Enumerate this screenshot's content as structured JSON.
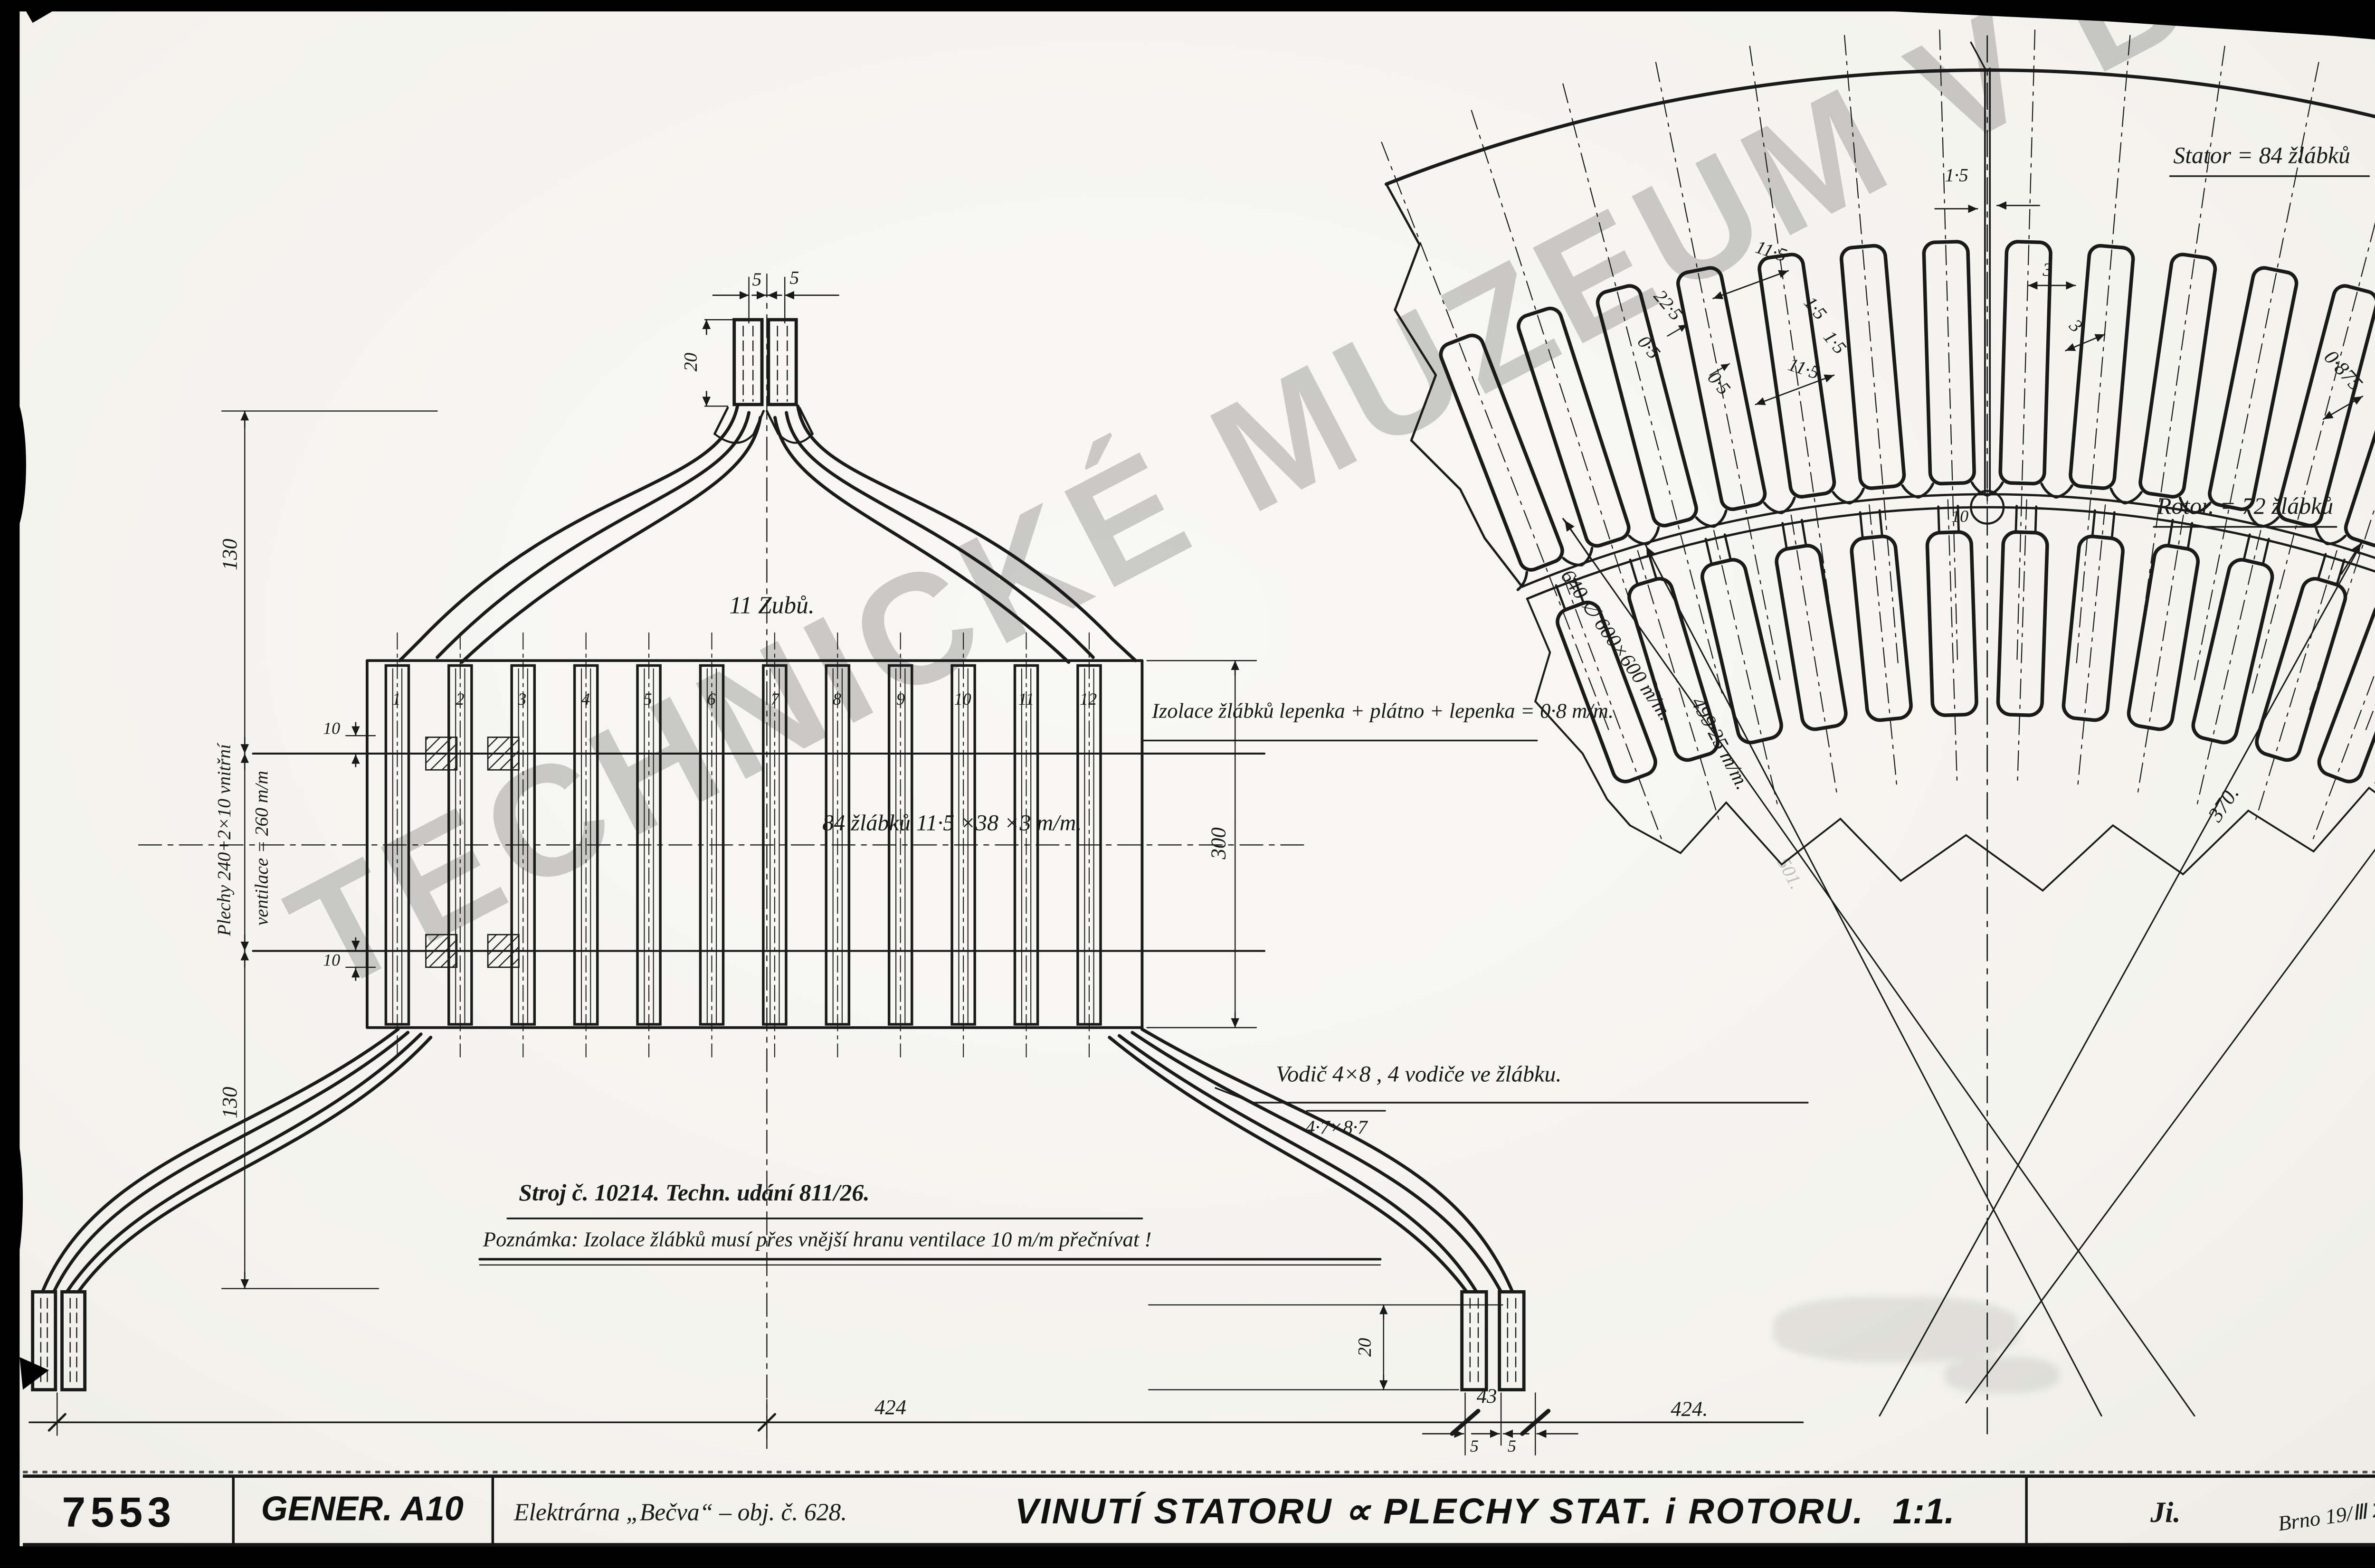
{
  "watermark": {
    "text": "TECHNICKÉ MUZEUM V BRNĚ"
  },
  "title_block": {
    "drawing_number": "7553",
    "machine": "GENER. A10",
    "plant": "Elektrárna „Bečva“ – obj. č. 628.",
    "title": "VINUTÍ STATORU ∝ PLECHY STAT. i ROTORU.",
    "scale": "1:1.",
    "initials": "Ji.",
    "place_date": "Brno 19/Ⅲ 2"
  },
  "left_view": {
    "teeth_label": "11 Zubů.",
    "slot_numbers": [
      "1",
      "2",
      "3",
      "4",
      "5",
      "6",
      "7",
      "8",
      "9",
      "10",
      "11",
      "12"
    ],
    "insulation_note": "Izolace žlábků lepenka + plátno + lepenka = 0·8 m/m.",
    "slots_note": "84 žlábků 11·5 ×38 ×3 m/m.",
    "conductor_note": "Vodič 4×8  , 4 vodiče ve žlábku.",
    "conductor_size_alt": "4·7×8·7",
    "machine_note": "Stroj č. 10214.  Techn. udání 811/26.",
    "remark_note": "Poznámka: Izolace žlábků musí přes vnější hranu ventilace 10 m/m přečnívat !",
    "stack_note_line1": "Plechy 240+2×10 vnitřní",
    "stack_note_line2": "ventilace = 260 m/m",
    "dims": {
      "top_gap_left": "5",
      "top_gap_right": "5",
      "top_lead_height": "20",
      "overhang_upper": "130",
      "overhang_lower": "130",
      "vent_upper": "10",
      "vent_lower": "10",
      "core_height": "300",
      "span_left": "424",
      "terminal_spacing": "43",
      "span_right": "424.",
      "lead_height_bottom": "20",
      "bottom_gap_left": "5",
      "bottom_gap_right": "5"
    }
  },
  "right_view": {
    "stator_label": "Stator = 84 žlábků",
    "rotor_label": "Rotor. = 72 žlábků",
    "dims": {
      "segment_joint": "1·5",
      "stator_slot_width": "11·5",
      "stator_slot_depth": "22·5",
      "wedge_a": "0·5",
      "wedge_b": "0·5",
      "lip_a": "1·5",
      "lip_b": "1·5",
      "rotor_slot_width": "11·5",
      "rotor_neck_a": "3",
      "rotor_neck_b": "3",
      "air_gap": "0·875",
      "stator_outer": "640 ∅ 600×600 m/m.",
      "stator_bore": "499·25 m/m.",
      "stator_bore_faint": "501.",
      "rotor_dim": "370.",
      "vent_hole": "10"
    }
  }
}
